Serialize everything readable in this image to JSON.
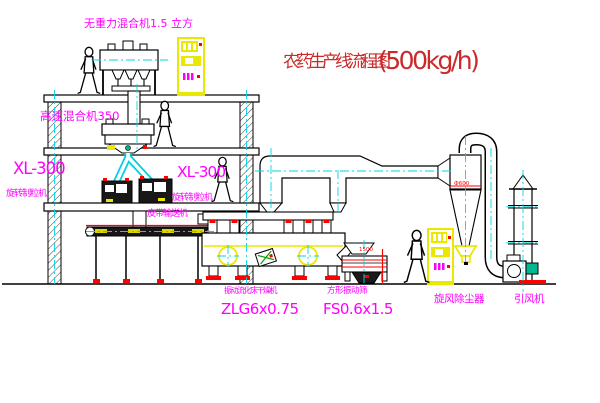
{
  "diagram": {
    "title": "农药生产线流程图",
    "title_capacity": "(500kg/h)"
  },
  "labels": {
    "gravity_mixer": "无重力混合机1.5 立方",
    "high_speed_mixer": "高速混合机350",
    "granulator_left_model": "XL-300",
    "granulator_left_name": "旋转制粒机",
    "granulator_mid_model": "XL-300",
    "granulator_mid_name": "旋转制粒机",
    "belt_conveyor": "皮带输送机",
    "dryer_name": "振动流化床干燥机",
    "dryer_model": "ZLG6x0.75",
    "sieve_name": "方形振动筛",
    "sieve_model": "FS0.6x1.5",
    "cyclone_name": "旋风除尘器",
    "fan_name": "引风机",
    "cyclone_dia": "Ф600",
    "sieve_dim": "1500"
  },
  "colors": {
    "label_magenta": "#ff00ff",
    "title_red": "#cc2a2a",
    "line_red": "#ff0000",
    "equipment_yellow": "#e8e800",
    "centerline_cyan": "#00d5e6",
    "motor_green": "#00b890",
    "line_black": "#000000",
    "background": "#ffffff"
  }
}
